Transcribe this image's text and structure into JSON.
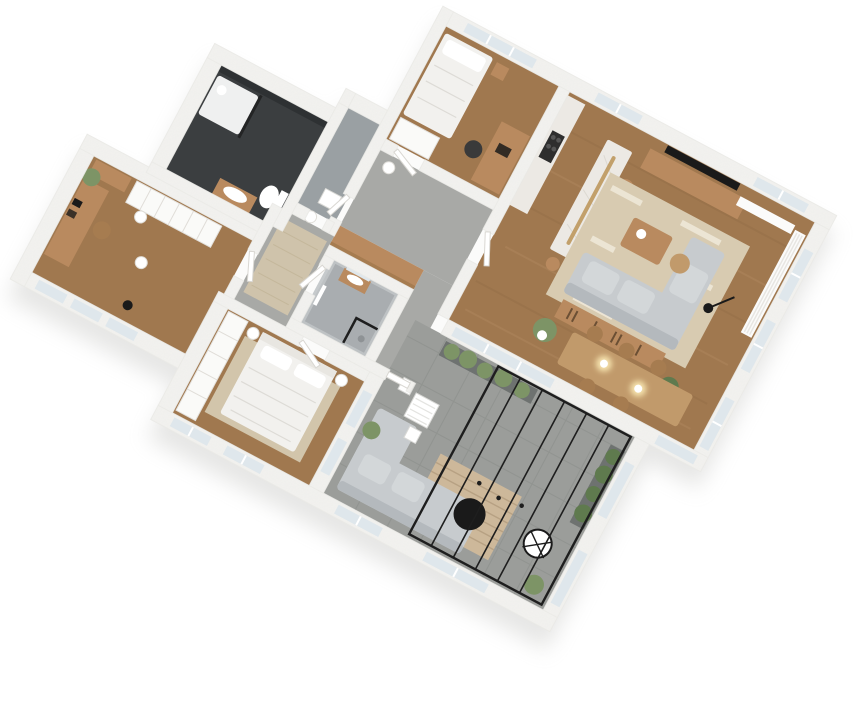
{
  "scene": {
    "title": "isometric-3d-floor-plan-render",
    "background": "#ffffff",
    "rotation_deg": 28,
    "palette": {
      "wall": "#f6f5f2",
      "wall_edge": "#e6e3df",
      "wall_gray": "#c0c4c6",
      "slab": "#fbfbfa",
      "shadow": "#b9b9b6",
      "wood_floor": "#a0784f",
      "wood_streak": "#8f6a45",
      "wood_streak_light": "#b68c63",
      "furn_wood": "#b98a5f",
      "furn_wood_dark": "#a67c50",
      "dining_wood": "#c19a6b",
      "marble": "#ece9e4",
      "marble_vein": "#d8d4cd",
      "tile": "#9b9d9a",
      "tile_line": "#8b8d8a",
      "hall_floor": "#a8a9a6",
      "bath_dark_floor": "#3b3e40",
      "bath_dark_wall": "#2e3133",
      "bath_gray_floor": "#a9adb0",
      "rug_living": "#d8cbb1",
      "rug_stripe": "#efe8d8",
      "rug_hall": "#cfc3ab",
      "rug_bed": "#d2c5ab",
      "slat_rug": "#cdb89a",
      "sofa": "#c7cbce",
      "sofa_dark": "#b4b9bd",
      "bed_white": "#f2f1ee",
      "linen_line": "#dddbd6",
      "white_obj": "#fafaf8",
      "glass": "#dfe7ec",
      "glass_frame": "#1e1e1e",
      "black": "#1a1a1a",
      "green": "#7d9466",
      "green_dark": "#5f7a4e",
      "gold": "#c2a06b",
      "glow": "#f6e3ae",
      "gray_steel": "#9aa0a3"
    },
    "rooms": [
      {
        "id": "office",
        "name": "Home office",
        "floor": "wood",
        "furniture": [
          "desk",
          "desk-chair",
          "wardrobe-row",
          "wall-shelf",
          "hanging-plant",
          "floor-lamp",
          "candle-lamps",
          "picture-frames"
        ]
      },
      {
        "id": "bathroom-1",
        "name": "Bathroom with shower",
        "floor": "dark-tile",
        "furniture": [
          "walk-in-shower",
          "shower-tray",
          "toilet",
          "wood-vanity-sink"
        ]
      },
      {
        "id": "wc",
        "name": "Guest WC",
        "floor": "gray-tile",
        "furniture": [
          "hand-basin"
        ]
      },
      {
        "id": "hallway",
        "name": "Hallway",
        "floor": "gray",
        "furniture": [
          "area-rug",
          "candle-lamp"
        ]
      },
      {
        "id": "bedroom-2",
        "name": "Kids / guest bedroom",
        "floor": "wood",
        "furniture": [
          "single-bed",
          "nightstand",
          "desk",
          "desk-chair",
          "wardrobe"
        ]
      },
      {
        "id": "living",
        "name": "Living / dining / kitchen",
        "floor": "wood",
        "furniture": [
          "kitchen-counter-cooktop",
          "marble-island",
          "gold-pendant-bar",
          "bar-stools",
          "tv",
          "media-sideboard",
          "l-shaped-sofa",
          "coffee-table",
          "side-table",
          "area-rug",
          "console-shelf",
          "dining-table",
          "dining-chairs",
          "pendant-lights",
          "floor-lamp",
          "potted-plants",
          "curtains"
        ]
      },
      {
        "id": "bathroom-2",
        "name": "Shower bathroom",
        "floor": "gray-tile",
        "furniture": [
          "vanity-with-mirror",
          "glass-shower",
          "towel-rail"
        ]
      },
      {
        "id": "entry",
        "name": "Entry vestibule",
        "floor": "gray",
        "furniture": [
          "front-door",
          "wood-top-closet"
        ]
      },
      {
        "id": "master-bedroom",
        "name": "Master bedroom",
        "floor": "wood",
        "furniture": [
          "double-bed",
          "bedside-lamps",
          "wardrobe-row",
          "area-rug"
        ]
      },
      {
        "id": "terrace",
        "name": "Terrace / winter garden",
        "floor": "tile",
        "furniture": [
          "glass-roof",
          "outdoor-sofa",
          "slatted-rug",
          "black-coffee-table",
          "hanging-egg-chair",
          "bistro-set",
          "planters"
        ]
      }
    ]
  }
}
